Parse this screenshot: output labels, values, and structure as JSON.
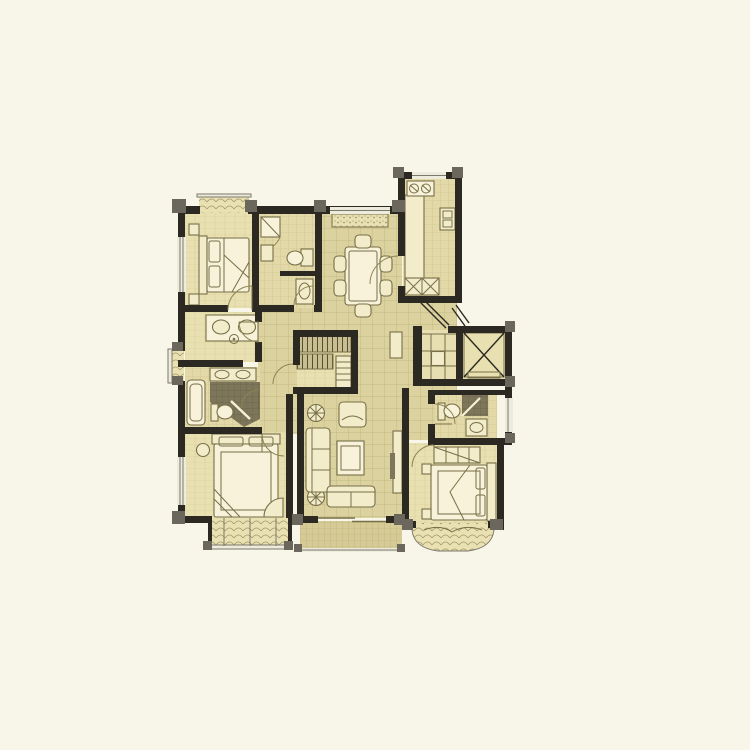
{
  "page": {
    "background": "#f8f6e8",
    "kind": "apartment-floor-plan"
  },
  "colors": {
    "bg": "#f8f6e8",
    "wall": "#2b2922",
    "pier": "#6c675c",
    "floorTile": "#dcd2a0",
    "tileLine": "#bdb179",
    "floorBath": "#e2d8a8",
    "bathLine": "#c9bd88",
    "floorWood": "#e9e0b1",
    "woodLine": "#d7cc98",
    "floorBalcony": "#d6cb96",
    "balconyLine": "#b9ad77",
    "floorLobby": "#e7dfb2",
    "showerDark": "#7d765a",
    "showerLine": "#696247",
    "closetBg": "#c8be8f",
    "closetLine": "#554e37",
    "seatBg": "#eae1b3",
    "dotColor": "#a0966a",
    "furnFill": "#f2ecca",
    "furnLight": "#f7f2d9",
    "furnLine": "#776f48",
    "windowFill": "#edebdc",
    "windowLine": "#7c786b",
    "arcLine": "#8d8455"
  },
  "plan": {
    "type": "floor-plan",
    "style": "architectural, no text labels",
    "rooms": [
      {
        "name": "bedroom-top-left",
        "furniture": [
          "double-bed",
          "nightstands",
          "bay-window-seat"
        ]
      },
      {
        "name": "bathroom-top",
        "furniture": [
          "shower",
          "toilet",
          "vanity"
        ]
      },
      {
        "name": "dining-room",
        "furniture": [
          "dining-table",
          "six-chairs",
          "flower-box-window"
        ]
      },
      {
        "name": "kitchen",
        "furniture": [
          "stove",
          "counter",
          "sink",
          "base-cabinets"
        ]
      },
      {
        "name": "entry-hall",
        "furniture": [
          "entry-door-swing"
        ]
      },
      {
        "name": "stair-lobby",
        "furniture": [
          "cross-floor-pattern"
        ]
      },
      {
        "name": "elevator",
        "furniture": [
          "elevator-car"
        ]
      },
      {
        "name": "study",
        "furniture": [
          "desk",
          "two-chairs",
          "bay-window"
        ]
      },
      {
        "name": "walk-in-closet",
        "furniture": [
          "wardrobe-shelving",
          "step-shelf"
        ]
      },
      {
        "name": "master-bathroom",
        "furniture": [
          "double-vanity",
          "bathtub",
          "shower",
          "toilet"
        ]
      },
      {
        "name": "master-bedroom",
        "furniture": [
          "double-bed",
          "nightstand",
          "corner-bench",
          "bay-window-seat"
        ]
      },
      {
        "name": "living-room",
        "furniture": [
          "sofa",
          "loveseat",
          "coffee-table",
          "armchair",
          "tv-cabinet",
          "plants"
        ]
      },
      {
        "name": "balcony",
        "furniture": []
      },
      {
        "name": "corridor-right",
        "furniture": [
          "cabinet"
        ]
      },
      {
        "name": "bathroom-right",
        "furniture": [
          "toilet",
          "shower",
          "vanity"
        ]
      },
      {
        "name": "bedroom-bottom-right",
        "furniture": [
          "double-bed",
          "wardrobe",
          "nightstands",
          "curved-bay-window"
        ]
      }
    ]
  }
}
